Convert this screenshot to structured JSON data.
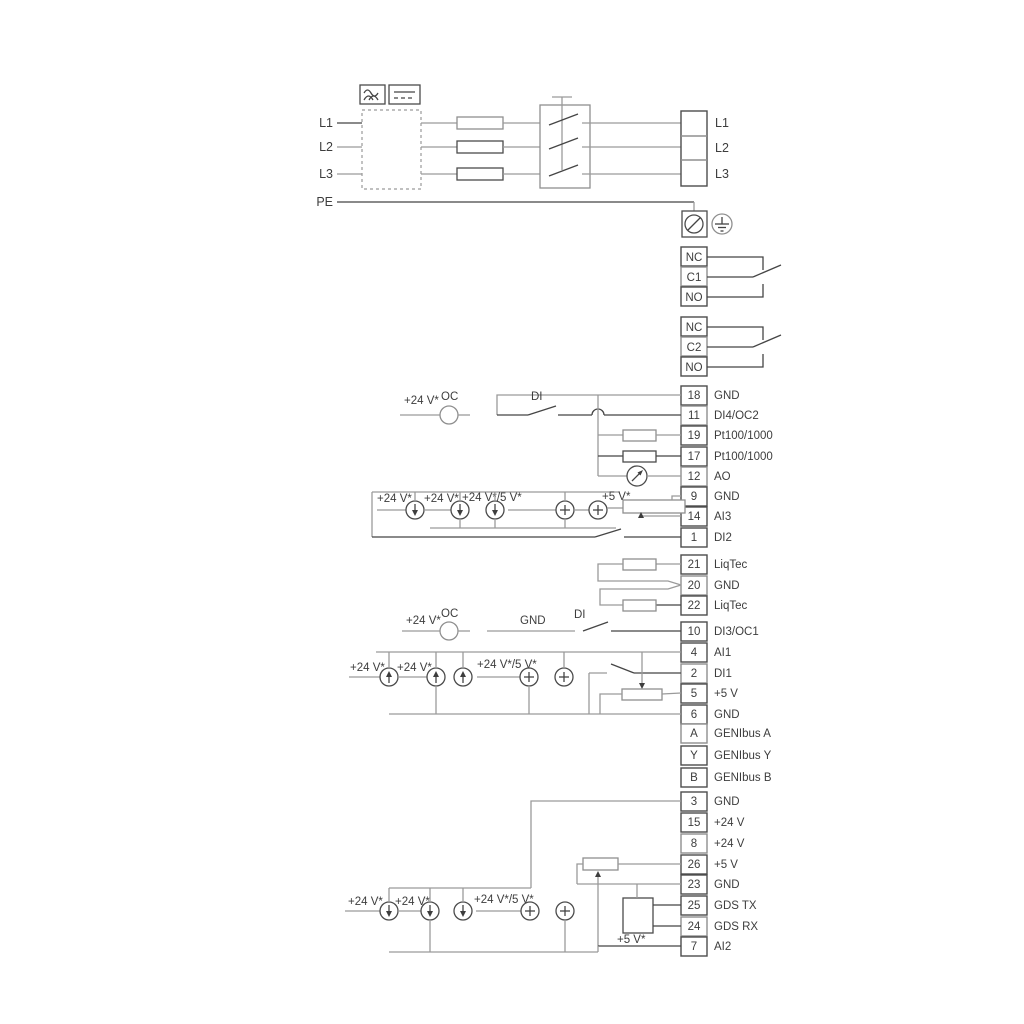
{
  "diagram_title": "pump-power-and-control-terminal-wiring-diagram",
  "colors": {
    "wire_gray": "#9a9a9a",
    "wire_dark": "#454545",
    "text": "#3d3d3d",
    "background": "#ffffff"
  },
  "power": {
    "l1": "L1",
    "l2": "L2",
    "l3": "L3",
    "pe": "PE"
  },
  "relay1": {
    "nc": "NC",
    "c": "C1",
    "no": "NO"
  },
  "relay2": {
    "nc": "NC",
    "c": "C2",
    "no": "NO"
  },
  "ann": {
    "p24": "+24 V*",
    "p245": "+24 V*/5 V*",
    "p5": "+5 V*",
    "oc": "OC",
    "di": "DI",
    "gnd": "GND"
  },
  "terminals": [
    {
      "n": "18",
      "t": "GND"
    },
    {
      "n": "11",
      "t": "DI4/OC2"
    },
    {
      "n": "19",
      "t": "Pt100/1000"
    },
    {
      "n": "17",
      "t": "Pt100/1000"
    },
    {
      "n": "12",
      "t": "AO"
    },
    {
      "n": "9",
      "t": "GND"
    },
    {
      "n": "14",
      "t": "AI3"
    },
    {
      "n": "1",
      "t": "DI2"
    },
    {
      "n": "21",
      "t": "LiqTec"
    },
    {
      "n": "20",
      "t": "GND"
    },
    {
      "n": "22",
      "t": "LiqTec"
    },
    {
      "n": "10",
      "t": "DI3/OC1"
    },
    {
      "n": "4",
      "t": "AI1"
    },
    {
      "n": "2",
      "t": "DI1"
    },
    {
      "n": "5",
      "t": "+5 V"
    },
    {
      "n": "6",
      "t": "GND"
    },
    {
      "n": "A",
      "t": "GENIbus A"
    },
    {
      "n": "Y",
      "t": "GENIbus Y"
    },
    {
      "n": "B",
      "t": "GENIbus B"
    },
    {
      "n": "3",
      "t": "GND"
    },
    {
      "n": "15",
      "t": "+24 V"
    },
    {
      "n": "8",
      "t": "+24 V"
    },
    {
      "n": "26",
      "t": "+5 V"
    },
    {
      "n": "23",
      "t": "GND"
    },
    {
      "n": "25",
      "t": "GDS TX"
    },
    {
      "n": "24",
      "t": "GDS RX"
    },
    {
      "n": "7",
      "t": "AI2"
    }
  ]
}
